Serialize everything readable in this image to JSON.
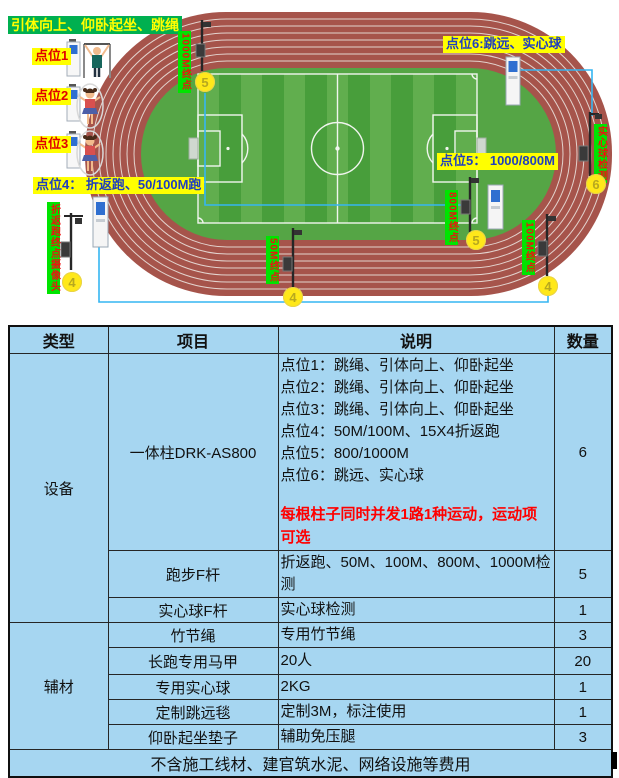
{
  "diagram": {
    "activity_label": "引体向上、仰卧起坐、跳绳",
    "points": {
      "p1": "点位1",
      "p2": "点位2",
      "p3": "点位3",
      "p4": "点位4： 折返跑、50/100M跑",
      "p5": "点位5： 1000/800M",
      "p6": "点位6:跳远、实心球"
    },
    "markers": {
      "shuttle_run_cam": "折返跑终点摄像头",
      "finish_1000m": "1000M终点",
      "finish_800m": "800M终点",
      "finish_100m": "100M终点",
      "finish_50m": "50M终点",
      "ball_detect": "实心球检测"
    },
    "circles": {
      "top5": "5",
      "right6": "6",
      "mid5": "5",
      "left4": "4",
      "mid4": "4",
      "right4": "4"
    }
  },
  "table": {
    "headers": [
      "类型",
      "项目",
      "说明",
      "数量"
    ],
    "groups": [
      {
        "category": "设备",
        "rows": [
          {
            "item": "一体柱DRK-AS800",
            "desc_lines": [
              "点位1：跳绳、引体向上、仰卧起坐",
              "点位2：跳绳、引体向上、仰卧起坐",
              "点位3：跳绳、引体向上、仰卧起坐",
              "点位4：50M/100M、15X4折返跑",
              "点位5：800/1000M",
              "点位6：跳远、实心球"
            ],
            "note": "每根柱子同时并发1路1种运动，运动项可选",
            "qty": "6"
          },
          {
            "item": "跑步F杆",
            "desc": "折返跑、50M、100M、800M、1000M检测",
            "qty": "5"
          },
          {
            "item": "实心球F杆",
            "desc": "实心球检测",
            "qty": "1"
          }
        ]
      },
      {
        "category": "辅材",
        "rows": [
          {
            "item": "竹节绳",
            "desc": "专用竹节绳",
            "qty": "3"
          },
          {
            "item": "长跑专用马甲",
            "desc": "20人",
            "qty": "20"
          },
          {
            "item": "专用实心球",
            "desc": "2KG",
            "qty": "1"
          },
          {
            "item": "定制跳远毯",
            "desc": "定制3M，标注使用",
            "qty": "1"
          },
          {
            "item": "仰卧起坐垫子",
            "desc": "辅助免压腿",
            "qty": "3"
          }
        ]
      }
    ],
    "footer": "不含施工线材、建官筑水泥、网络设施等费用"
  },
  "colors": {
    "table_bg": "#A6D6F1",
    "track_red": "#A6544B",
    "lane_line": "#E3D3CE",
    "field_green_apron": "#55A545",
    "field_green_light": "#61AE4E",
    "field_green_dark": "#489E3B",
    "label_yellow_bg": "#FFFF00",
    "label_green_bg": "#00B050",
    "marker_green_bg": "#00E400",
    "marker_red_text": "#EE1111",
    "point_blue_text": "#1F3FBF",
    "point_red_text": "#E00000",
    "note_red": "#FF0000",
    "circle_yellow": "#FFE81A",
    "wire_blue": "#35B5F2"
  }
}
